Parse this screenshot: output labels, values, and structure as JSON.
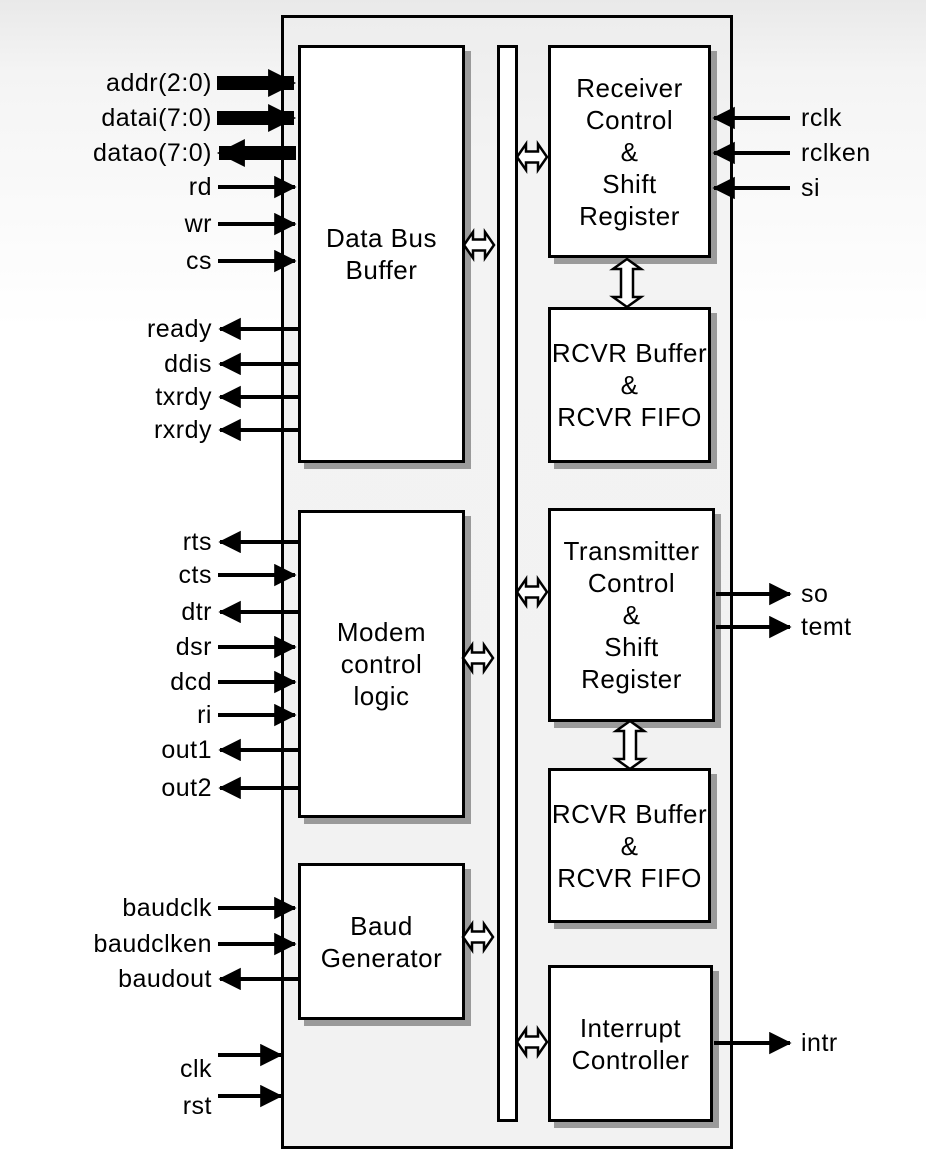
{
  "diagram": {
    "kind": "uart-block-diagram"
  },
  "blocks": {
    "data_bus_buffer": "Data Bus\nBuffer",
    "receiver_control": "Receiver\nControl\n&\nShift Register",
    "rcvr_buffer_top": "RCVR Buffer\n&\nRCVR FIFO",
    "modem_control_logic": "Modem\ncontrol\nlogic",
    "transmitter_control": "Transmitter\nControl\n&\nShift Register",
    "rcvr_buffer_bottom": "RCVR Buffer\n&\nRCVR FIFO",
    "baud_generator": "Baud\nGenerator",
    "interrupt_controller": "Interrupt\nController"
  },
  "signals": {
    "left": {
      "addr": "addr(2:0)",
      "datai": "datai(7:0)",
      "datao": "datao(7:0)",
      "rd": "rd",
      "wr": "wr",
      "cs": "cs",
      "ready": "ready",
      "ddis": "ddis",
      "txrdy": "txrdy",
      "rxrdy": "rxrdy",
      "rts": "rts",
      "cts": "cts",
      "dtr": "dtr",
      "dsr": "dsr",
      "dcd": "dcd",
      "ri": "ri",
      "out1": "out1",
      "out2": "out2",
      "baudclk": "baudclk",
      "baudclken": "baudclken",
      "baudout": "baudout",
      "clk": "clk",
      "rst": "rst"
    },
    "right": {
      "rclk": "rclk",
      "rclken": "rclken",
      "si": "si",
      "so": "so",
      "temt": "temt",
      "intr": "intr"
    }
  },
  "colors": {
    "outline": "#000000",
    "block_fill": "#ffffff",
    "chip_fill": "#f2f2f2",
    "shadow": "#9a9a9a"
  }
}
